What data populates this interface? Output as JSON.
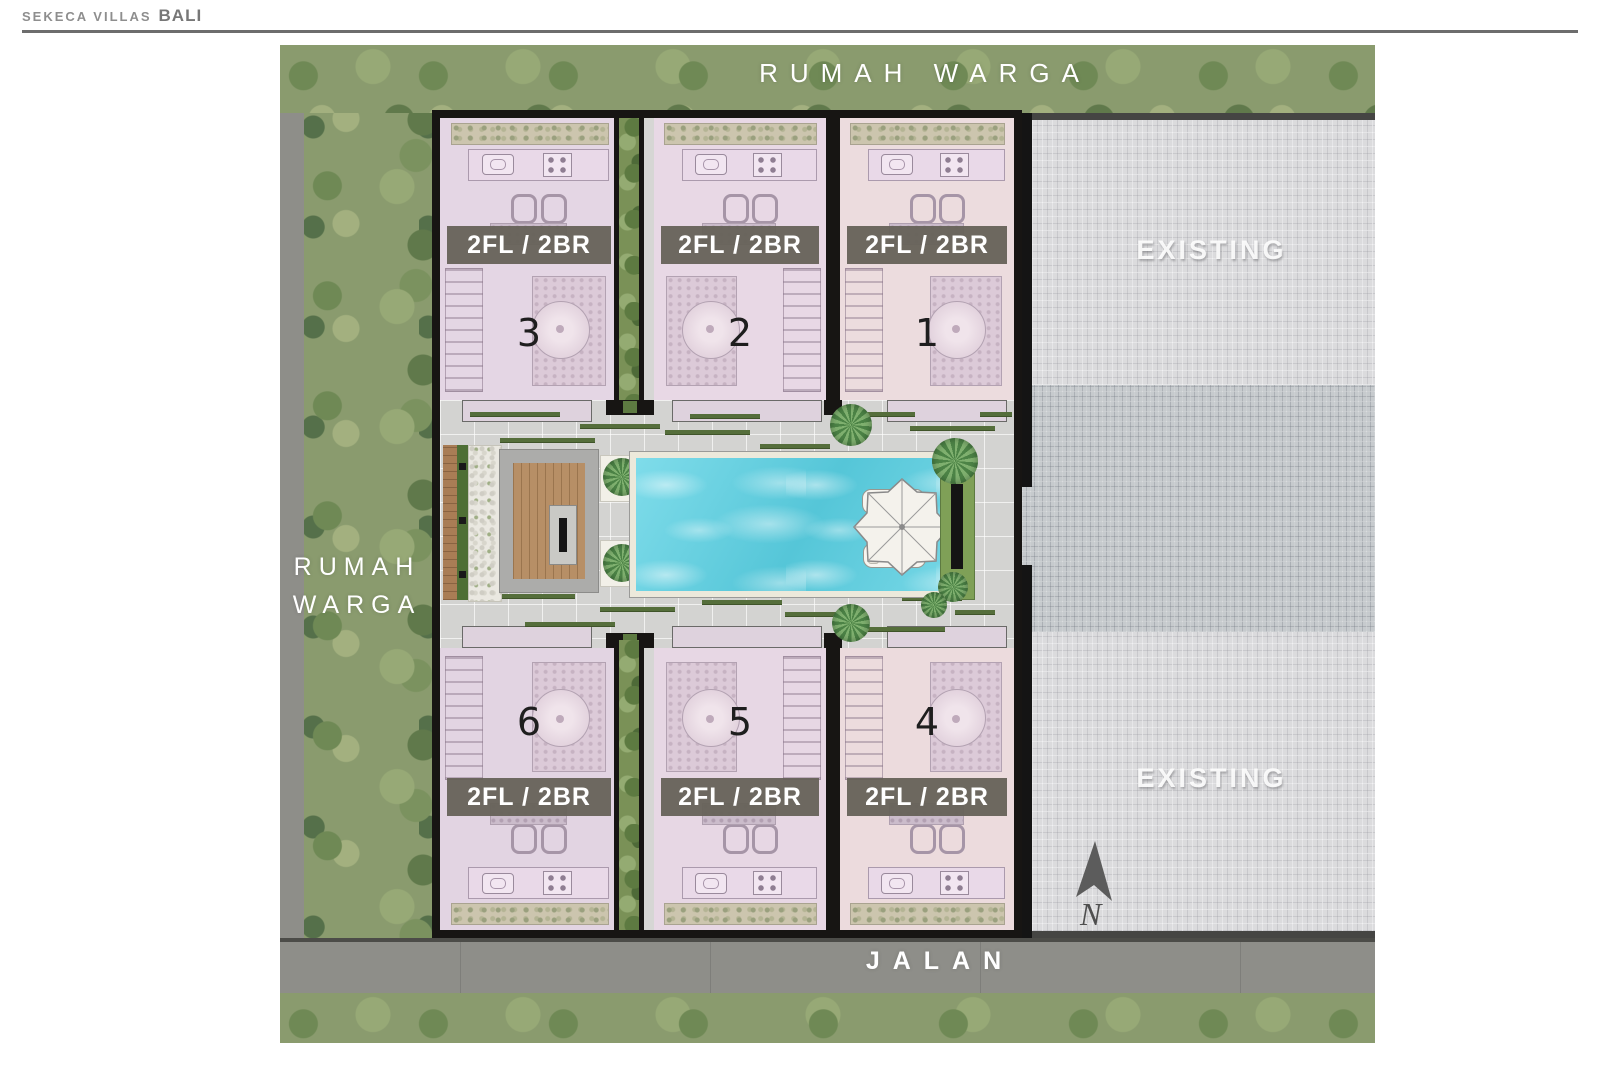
{
  "header": {
    "brand": "SEKECA VILLAS",
    "brand_bold": "BALI"
  },
  "surroundings": {
    "top_label": "RUMAH WARGA",
    "left_label_line1": "RUMAH",
    "left_label_line2": "WARGA",
    "road_label": "JALAN"
  },
  "existing_area": {
    "top_label": "EXISTING",
    "bottom_label": "EXISTING"
  },
  "compass": {
    "north_label": "N"
  },
  "villas": [
    {
      "number": "3",
      "spec": "2FL / 2BR",
      "row": "top"
    },
    {
      "number": "2",
      "spec": "2FL / 2BR",
      "row": "top"
    },
    {
      "number": "1",
      "spec": "2FL / 2BR",
      "row": "top"
    },
    {
      "number": "6",
      "spec": "2FL / 2BR",
      "row": "bottom"
    },
    {
      "number": "5",
      "spec": "2FL / 2BR",
      "row": "bottom"
    },
    {
      "number": "4",
      "spec": "2FL / 2BR",
      "row": "bottom"
    }
  ],
  "colors": {
    "villa_fill": "#e7d7e4",
    "spec_banner": "#65615a",
    "pool_water": "#63cedf",
    "wood_deck": "#b78f66",
    "trees": "#8a9b6e",
    "road": "#8e8e89",
    "existing_paving_light": "#dbdbdd",
    "existing_paving_dark": "#c6cacd",
    "wall": "#171513",
    "grass_strip": "#556e3b"
  }
}
